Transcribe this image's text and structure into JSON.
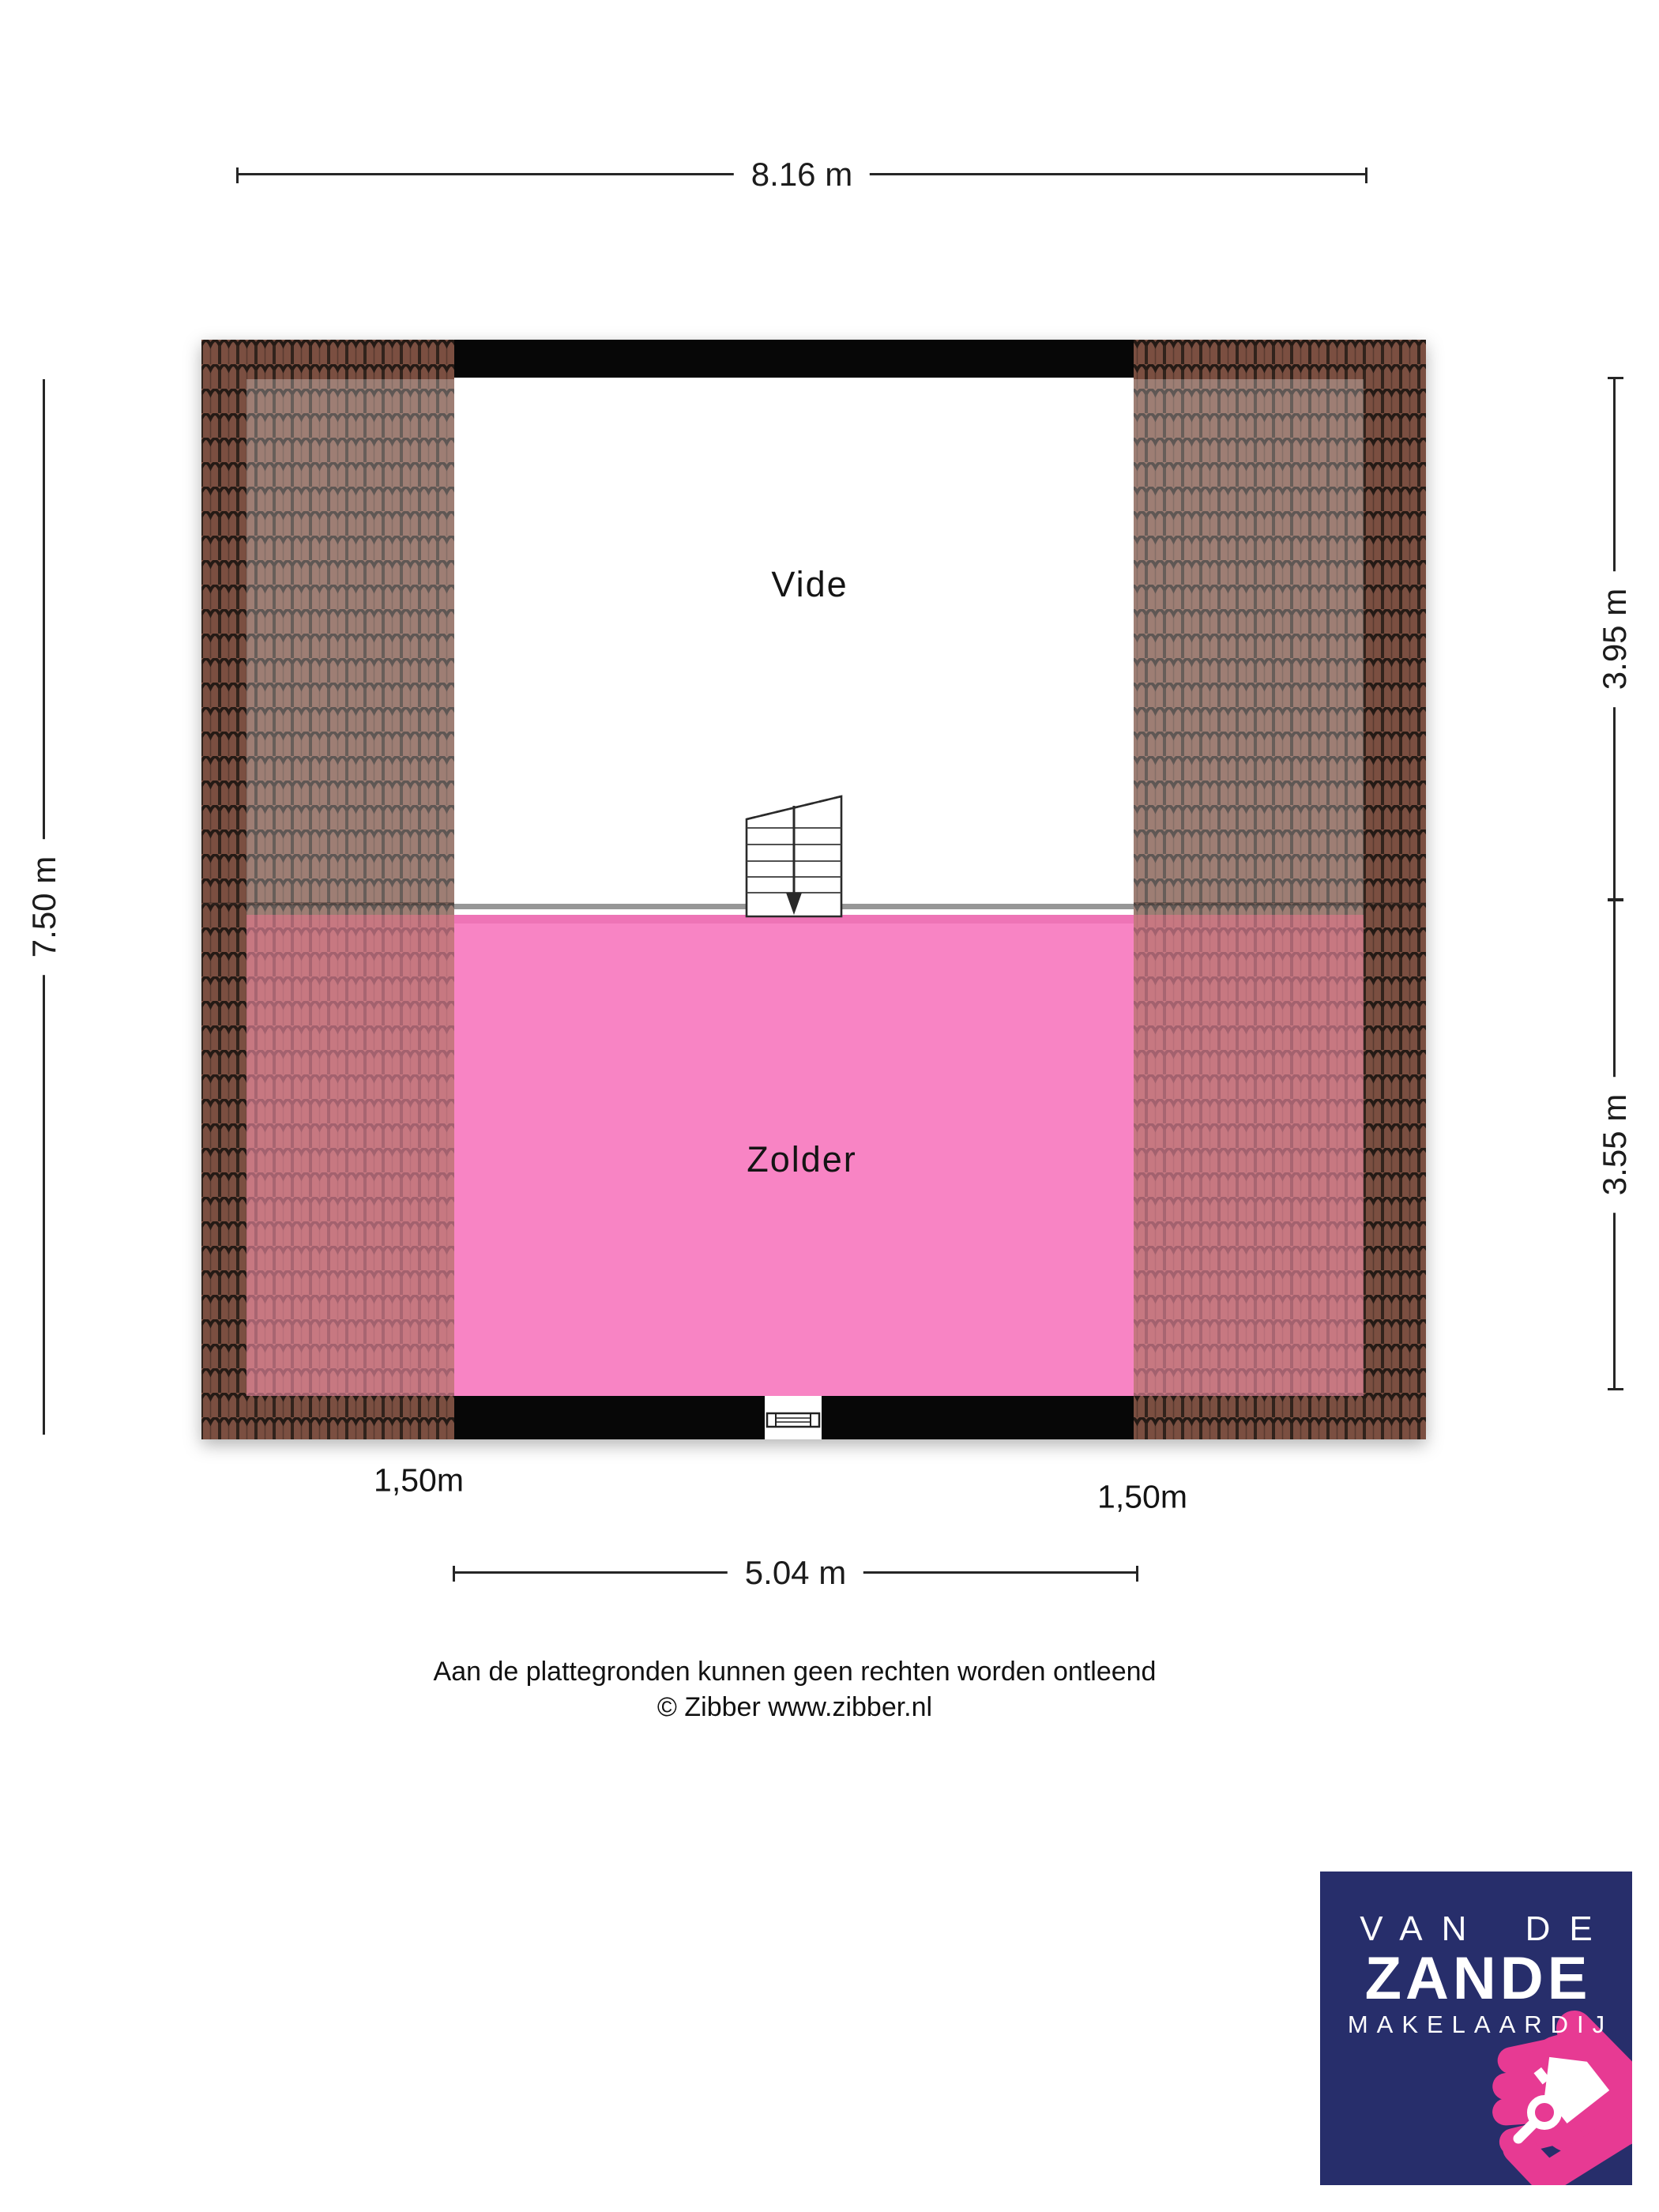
{
  "plan": {
    "rooms": [
      {
        "name": "Vide"
      },
      {
        "name": "Zolder"
      }
    ]
  },
  "dimensions": {
    "top_width": "8.16 m",
    "left_height": "7.50 m",
    "right_top": "3.95 m",
    "right_bottom": "3.55 m",
    "bottom_width": "5.04 m",
    "headroom_left": "1,50m",
    "headroom_right": "1,50m"
  },
  "disclaimer": {
    "line1": "Aan de plattegronden kunnen geen rechten worden ontleend",
    "line2": "© Zibber www.zibber.nl"
  },
  "logo": {
    "line1": "VAN DE",
    "line2": "ZANDE",
    "line3": "MAKELAARDIJ"
  },
  "icons": {
    "stairs": "staircase-down-arrow",
    "window": "window-symbol",
    "logo_house": "house-icon",
    "logo_magnifier": "magnifier-icon"
  },
  "colors": {
    "zolder_pink": "#F884C4",
    "zolder_pink_shade": "#EE74B6",
    "roof_tile_brown": "#7B4F41",
    "wall_black": "#070707",
    "logo_navy": "#272E6B",
    "logo_pink": "#E73A93"
  }
}
